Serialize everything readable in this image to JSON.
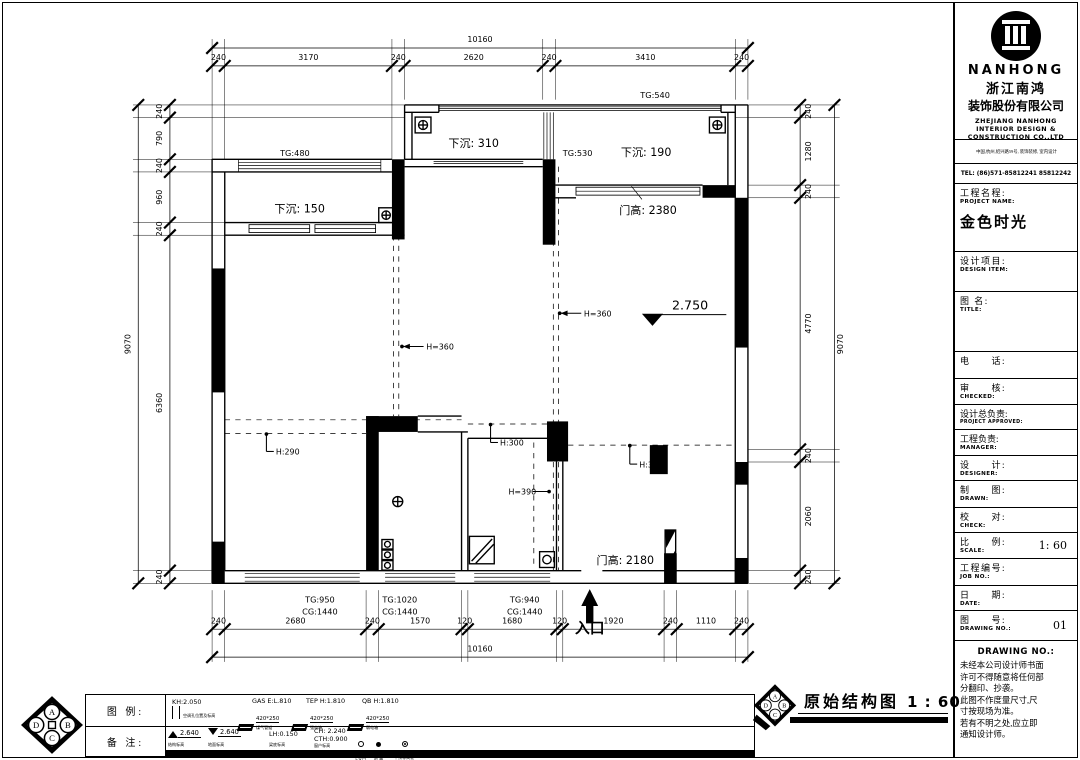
{
  "title_block": {
    "logo_text": "NANHONG",
    "company_cn_1": "浙江南鸿",
    "company_cn_2": "装饰股份有限公司",
    "company_en_1": "ZHEJIANG NANHONG",
    "company_en_2": "INTERIOR DESIGN &",
    "company_en_3": "CONSTRUCTION CO.,LTD",
    "address": "中国,杭州,绍兴路59号, 装饰装修, 室内设计",
    "tel": "TEL: (86)571-85812241 85812242",
    "fields": {
      "project_cn": "工程名程:",
      "project_en": "PROJECT NAME:",
      "project_value": "金色时光",
      "design_item_cn": "设计项目:",
      "design_item_en": "DESIGN ITEM:",
      "title_cn": "图 名:",
      "title_en": "TITLE:",
      "phone_cn": "电　　话:",
      "checked_cn": "审　　核:",
      "checked_en": "CHECKED:",
      "approved_cn": "设计总负责:",
      "approved_en": "PROJECT APPROVED:",
      "manager_cn": "工程负责:",
      "manager_en": "MANAGER:",
      "designer_cn": "设　　计:",
      "designer_en": "DESIGNER:",
      "drawn_cn": "制　　图:",
      "drawn_en": "DRAWN:",
      "check_cn": "校　　对:",
      "check_en": "CHECK:",
      "scale_cn": "比　　例:",
      "scale_en": "SCALE:",
      "scale_value": "1: 60",
      "job_cn": "工程编号:",
      "job_en": "JOB NO.:",
      "date_cn": "日　　期:",
      "date_en": "DATE:",
      "drawing_cn": "图　　号:",
      "drawing_en": "DRAWING NO.:",
      "drawing_value": "01"
    },
    "notice_title": "DRAWING NO.:",
    "notice_lines": [
      "未经本公司设计师书面",
      "许可不得随意将任何部",
      "分翻印、抄袭。",
      "此图不作度量尺寸,尺",
      "寸按现场为准。",
      "若有不明之处,应立即",
      "通知设计师。"
    ]
  },
  "plan": {
    "dims": {
      "top_total": "10160",
      "top": [
        "240",
        "3170",
        "240",
        "2620",
        "240",
        "3410",
        "240"
      ],
      "left_total": "9070",
      "left": [
        "240",
        "790",
        "240",
        "960",
        "240",
        "6360",
        "240"
      ],
      "right_total": "9070",
      "right": [
        "240",
        "1280",
        "240",
        "4770",
        "240",
        "2060",
        "240"
      ],
      "bottom_total": "10160",
      "bottom": [
        "240",
        "2680",
        "240",
        "1570",
        "120",
        "1680",
        "120",
        "1920",
        "240",
        "1110",
        "240"
      ]
    },
    "labels": {
      "tg540": "TG:540",
      "tg530": "TG:530",
      "tg480": "TG:480",
      "sink310": "下沉: 310",
      "sink190": "下沉: 190",
      "sink150": "下沉: 150",
      "door_top": "门高: 2380",
      "level": "2.750",
      "h360_a": "H=360",
      "h360_b": "H=360",
      "h290": "H:290",
      "h300_a": "H:300",
      "h390": "H=390",
      "h300_b": "H:300",
      "door_bottom": "门高: 2180",
      "entry": "入口",
      "tg950": "TG:950",
      "cg1440_a": "CG:1440",
      "tg1020": "TG:1020",
      "cg1440_b": "CG:1440",
      "tg940": "TG:940",
      "cg1440_c": "CG:1440"
    }
  },
  "legend": {
    "row1_label": "图 例:",
    "row2_label": "备 注:",
    "kh": {
      "text": "KH:2.050",
      "sub": "空调孔位置及标高"
    },
    "gas": {
      "text": "GAS E:L.810",
      "size": "420*250",
      "sub": "煤气管道"
    },
    "tep": {
      "text": "TEP H:1.810",
      "size": "420*250",
      "sub": "强电箱"
    },
    "qb": {
      "text": "QB H:1.810",
      "size": "420*250",
      "sub": "弱电箱"
    },
    "struct_level": {
      "text": "2.640",
      "sub": "结构标高"
    },
    "floor_level": {
      "text": "2.640",
      "sub": "地面标高"
    },
    "lh": {
      "text": "LH:0.150",
      "sub": "梁底标高"
    },
    "ch": {
      "text": "CH: 2.240",
      "text2": "CTH:0.900",
      "sub": "窗户标高"
    },
    "drain1": {
      "sub": "下水口"
    },
    "drain2": {
      "sub": "地 漏"
    },
    "ceiling": {
      "sub": "平顶标高差"
    }
  },
  "stamp": {
    "title": "原始结构图",
    "scale": "1 : 60"
  },
  "compass": {
    "top": "A",
    "right": "B",
    "bottom": "C",
    "left": "D"
  }
}
